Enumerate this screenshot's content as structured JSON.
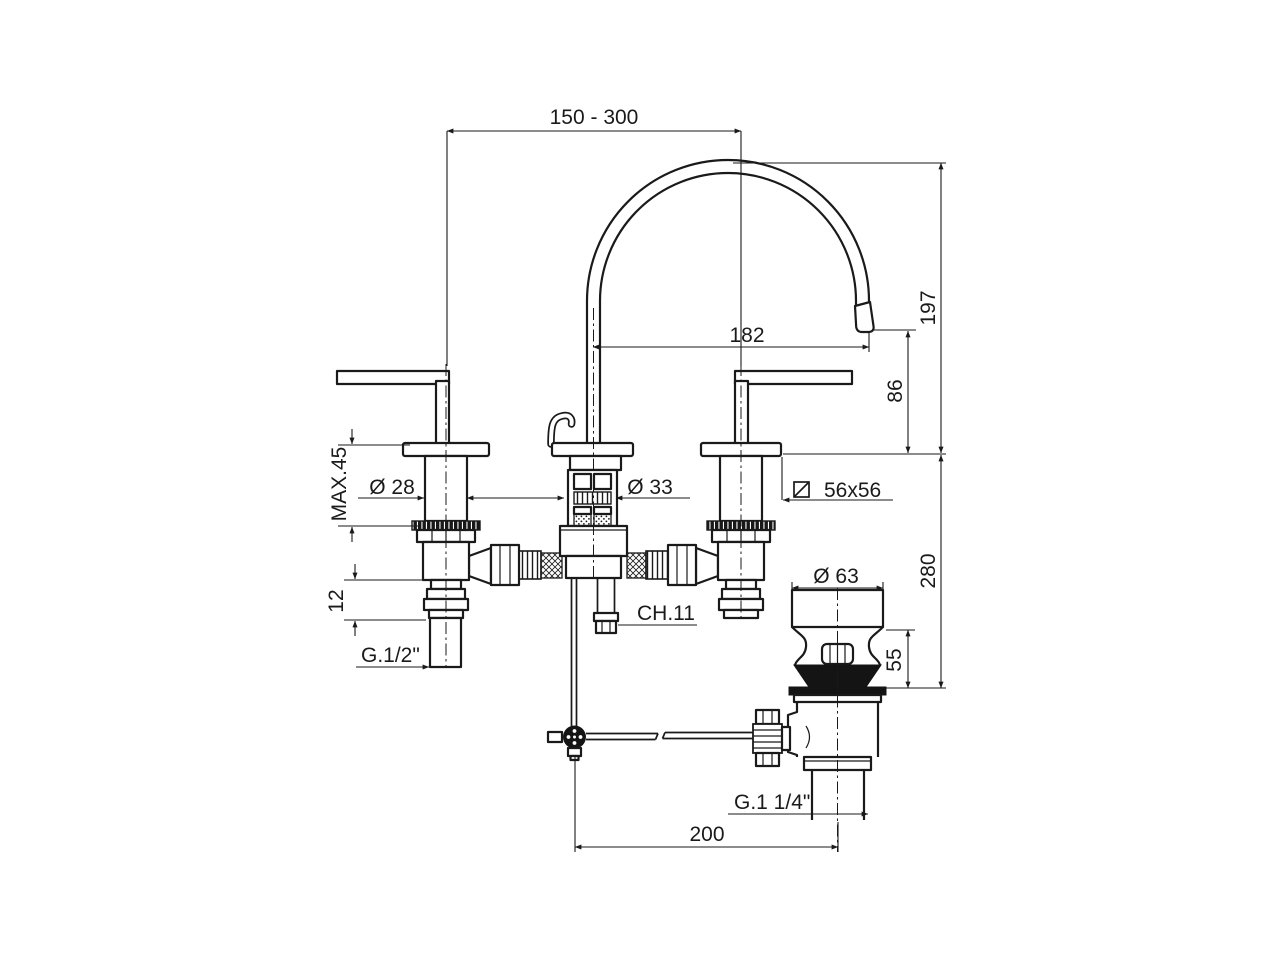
{
  "meta": {
    "drawing_type": "dimensioned technical drawing",
    "subject": "3-hole basin mixer tap with swan-neck spout and pop-up waste",
    "units": "mm",
    "ink_color": "#1a1a1a",
    "background_color": "#ffffff"
  },
  "labels": {
    "spout_reach_range": "150 - 300",
    "spout_height": "197",
    "spout_projection": "182",
    "outlet_clearance": "86",
    "max_mount_thickness": "MAX.45",
    "handle_shank_diameter": "Ø 28",
    "body_shank_diameter": "Ø 33",
    "base_plate_size": "56x56",
    "under_deck_depth": "280",
    "inlet_step_height": "12",
    "supply_thread": "G.1/2\"",
    "rod_wrench_size": "CH.11",
    "waste_cap_diameter": "Ø 63",
    "waste_body_height": "55",
    "waste_thread": "G.1 1/4\"",
    "drain_offset": "200"
  }
}
